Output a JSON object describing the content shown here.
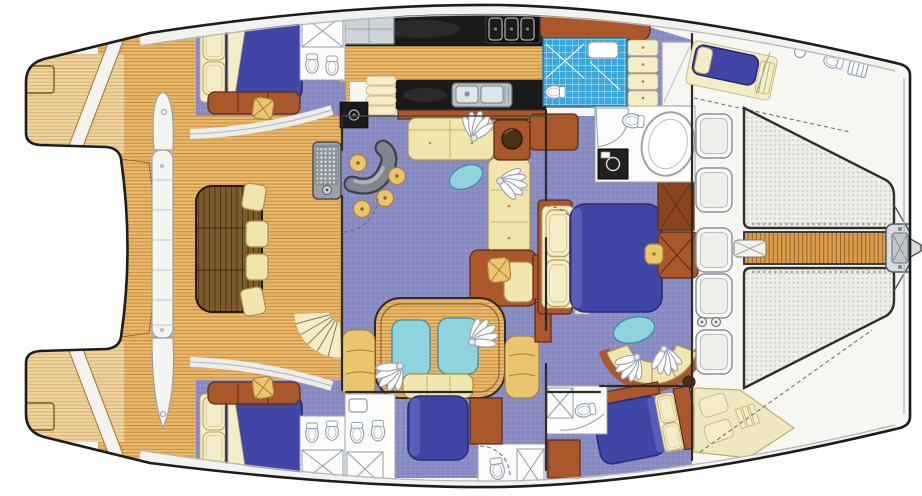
{
  "meta": {
    "title": "Sailing catamaran yacht — overhead deck and accommodation floor plan",
    "view": "top-down illustrated floor plan",
    "text_on_image": "none"
  },
  "palette": {
    "hull": "#f7f6f3",
    "outline": "#1d1d1b",
    "trim": "#b4b8bc",
    "teak": "#e9b767",
    "teak_light": "#eed39d",
    "walk_teak": "#d89b49",
    "table_teak": "#7c5c2e",
    "carpet": "#8689c1",
    "bed_blue": "#4046a6",
    "bed_blue_dark": "#272c74",
    "linen": "#f4edc8",
    "sofa": "#f1e5ae",
    "sofa_line": "#a8904c",
    "wood_brown": "#a9572b",
    "wood_brown_dark": "#5f2c10",
    "aqua": "#8fd4dc",
    "tile": "#38a7da",
    "stool": "#eac56d",
    "bar_gray": "#80868c",
    "counter": "#1a1a1a",
    "fixture": "#8f9bb0",
    "net_dot": "#cbcbc5"
  },
  "legend": {
    "vessel": {
      "type": "catamaran",
      "hulls": 2,
      "bow_side": "right",
      "stern_side": "left"
    },
    "areas": [
      {
        "id": "stern-platforms",
        "name": "twin stern swim platforms with deck boxes and boarding steps"
      },
      {
        "id": "aft-cockpit",
        "name": "aft cockpit: teak deck, teak dining table, bench seat, 4 loose cushions, wet-bar sink console, curved staircase to flybridge"
      },
      {
        "id": "salon",
        "name": "main salon: carpeted, L-shaped settee, glass cocktail table, curved gray bar with 4 round stools, planter table"
      },
      {
        "id": "galley",
        "name": "galley: refrigerator, black counters, 3-burner cooktop, double stainless sink, lower cabinets, companionway steps"
      },
      {
        "id": "port-aft-cabin",
        "name": "port aft guest cabin: double berth with pillows, settee, vanity stool, ensuite head with shower and twin fixtures"
      },
      {
        "id": "starboard-aft-cabin",
        "name": "starboard aft guest cabin: double berth with pillows, settee, vanity stool, ensuite head with shower"
      },
      {
        "id": "owner-cabin",
        "name": "owner stateroom amidships: queen berth, writing desk with stool, wardrobe, lounge with curved settee, oval glass table, fan ornaments"
      },
      {
        "id": "owner-bath",
        "name": "owner bathroom: oval bathtub, toilet, corner shower, dark vanity sink, blue-tiled shower room with toilet and basin"
      },
      {
        "id": "aft-center-cabin",
        "name": "aft-center cabin: double berth, twin glass-top dressing console with bench and fan ornaments, curved side cabinets, spiral stair"
      },
      {
        "id": "center-heads",
        "name": "guest day heads: toilets, showers with glass screens, basins"
      },
      {
        "id": "port-forward-cabin",
        "name": "port forward single berth cabin with drawer stack and mirrored wardrobe"
      },
      {
        "id": "crew-bow-area",
        "name": "port bow crew berth and crew head with basin, toilet and shower grate; starboard bow sail locker with cushions"
      },
      {
        "id": "foredeck",
        "name": "foredeck: 5 deck hatches, twin filler fittings, two bow trampoline nets, central teak walkway, anchor windlass, bowsprit"
      }
    ],
    "repeated_glyphs": [
      {
        "id": "fan-ornament",
        "count": 6,
        "meaning": "white hand-fan decorative object"
      },
      {
        "id": "deck-hatch",
        "count": 5
      },
      {
        "id": "bar-stool",
        "count": 4
      },
      {
        "id": "toilet",
        "count": 8
      }
    ]
  }
}
